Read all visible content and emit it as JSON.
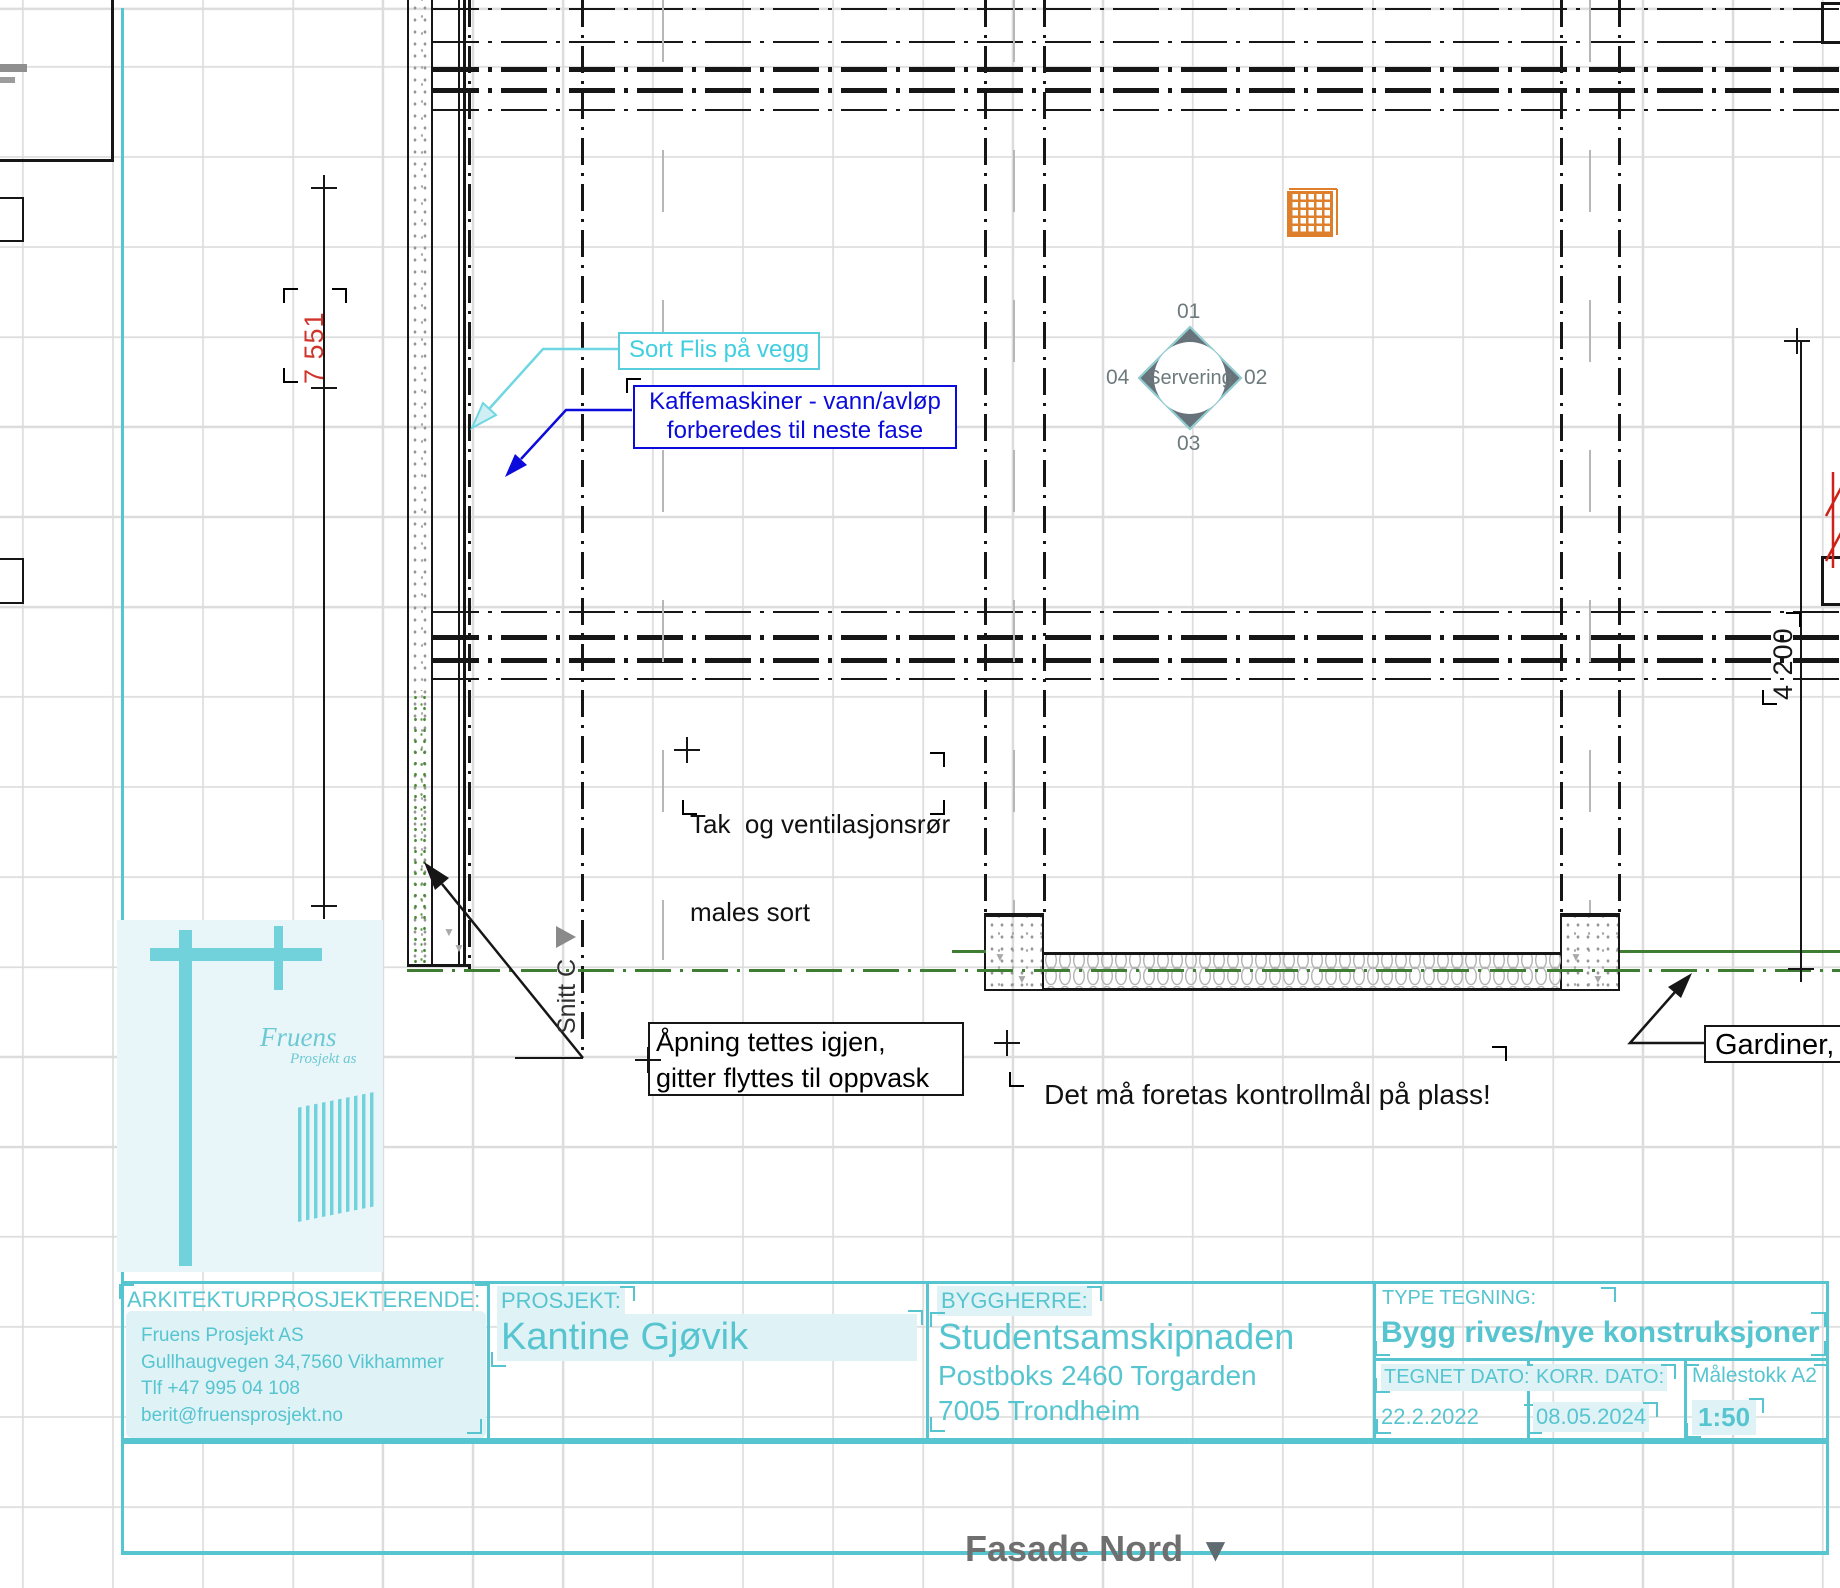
{
  "colors": {
    "frame_cyan": "#56c5d0",
    "annotation_blue": "#0b0bdb",
    "annotation_cyan": "#3fcfe0",
    "dim_red": "#d0342a",
    "ground_green": "#3f7d33",
    "grille_orange": "#de7f2c",
    "symbol_gray": "#68727a"
  },
  "annotations": {
    "sort_flis": "Sort Flis på vegg",
    "kaffe_line1": "Kaffemaskiner - vann/avløp",
    "kaffe_line2": "forberedes til neste fase",
    "tak_line1": "Tak  og ventilasjonsrør",
    "tak_line2": "males sort",
    "apning_line1": "Åpning tettes igjen,",
    "apning_line2": "gitter flyttes til oppvask",
    "kontrollmal": "Det må foretas kontrollmål på plass!",
    "gardiner": "Gardiner,",
    "snitt": "Snitt C",
    "dim_left": "7 551",
    "dim_right": "4 200"
  },
  "servering": {
    "label": "Servering",
    "top": "01",
    "right": "02",
    "bottom": "03",
    "left": "04"
  },
  "logo": {
    "name": "Fruens",
    "sub": "Prosjekt as"
  },
  "title_block": {
    "arch_header": "ARKITEKTURPROSJEKTERENDE:",
    "arch_lines": [
      "Fruens Prosjekt AS",
      "Gullhaugvegen 34,7560 Vikhammer",
      "Tlf +47 995 04 108",
      "berit@fruensprosjekt.no"
    ],
    "prosjekt_header": "PROSJEKT:",
    "prosjekt_value": "Kantine Gjøvik",
    "byggherre_header": "BYGGHERRE:",
    "byggherre_lines": [
      "Studentsamskipnaden",
      "Postboks 2460 Torgarden",
      "7005 Trondheim"
    ],
    "type_header": "TYPE TEGNING:",
    "type_value": "Bygg rives/nye konstruksjoner",
    "tegnet_label": "TEGNET DATO:",
    "tegnet_value": "22.2.2022",
    "korr_label": "KORR. DATO:",
    "korr_value": "08.05.2024",
    "scale_label": "Målestokk A2",
    "scale_value": "1:50"
  },
  "footer": {
    "view_label": "Fasade Nord"
  }
}
